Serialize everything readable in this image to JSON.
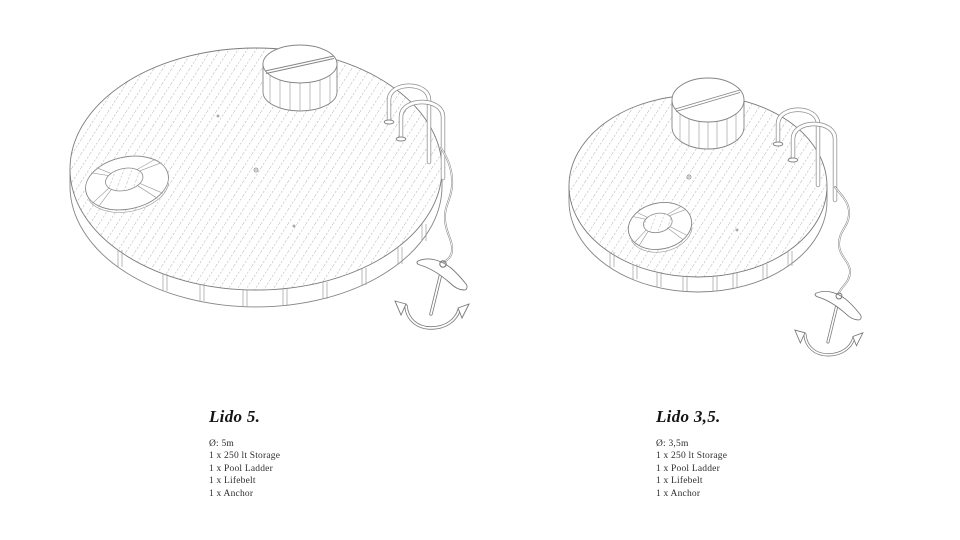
{
  "sheet": {
    "background": "#ffffff",
    "ink_color": "#141414",
    "line_color": "#858585",
    "hatch_color": "#c0c0c0"
  },
  "figures": [
    {
      "title": "Lido 5.",
      "specs": [
        "Ø: 5m",
        "1 x 250 lt Storage",
        "1 x Pool Ladder",
        "1 x Lifebelt",
        "1 x Anchor"
      ]
    },
    {
      "title": "Lido 3,5.",
      "specs": [
        "Ø: 3,5m",
        "1 x 250 lt Storage",
        "1 x Pool Ladder",
        "1 x Lifebelt",
        "1 x Anchor"
      ]
    }
  ]
}
